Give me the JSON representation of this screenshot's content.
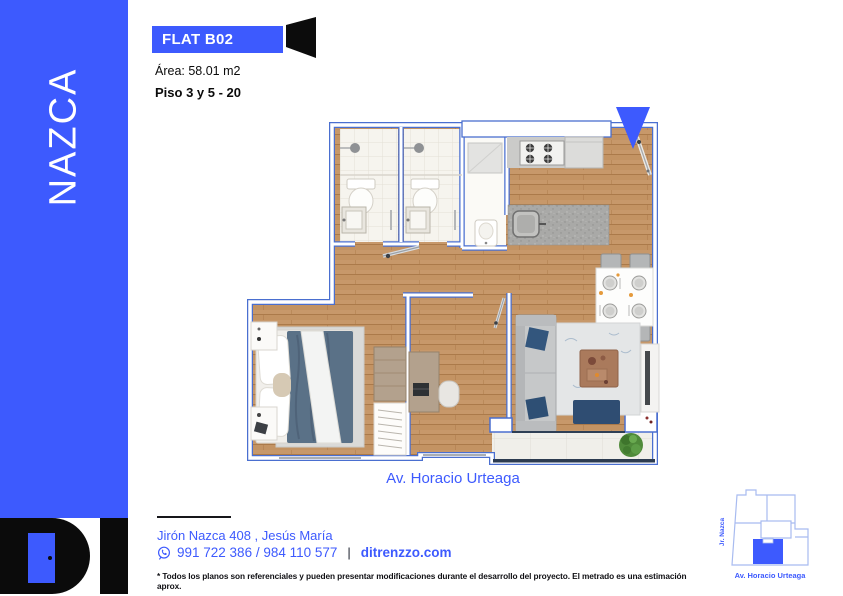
{
  "colors": {
    "accent": "#3d5afe",
    "wall_outline": "#4a6fd0",
    "wood": "#c7986a",
    "logo_black": "#0b0b0b"
  },
  "sidebar": {
    "brand": "NAZCA"
  },
  "logo": {
    "brand": "DI"
  },
  "header": {
    "unit": "FLAT B02",
    "area": "Área: 58.01 m2",
    "floors": "Piso 3 y 5 - 20"
  },
  "plan": {
    "caption": "Av. Horacio Urteaga"
  },
  "footer": {
    "address": "Jirón Nazca 408 , Jesús María",
    "phone": "991 722 386 / 984 110 577",
    "separator": "|",
    "website": "ditrenzzo.com",
    "disclaimer": "* Todos los planos son referenciales y pueden presentar modificaciones durante el desarrollo del proyecto. El metrado es una estimación aprox."
  },
  "minimap": {
    "street_side": "Jr. Nazca",
    "street_front": "Av. Horacio Urteaga"
  },
  "icons": {
    "phone_icon": "whatsapp-circle",
    "unit_marker_icon": "door-silhouette",
    "entry_marker_icon": "north-arrow-down"
  }
}
